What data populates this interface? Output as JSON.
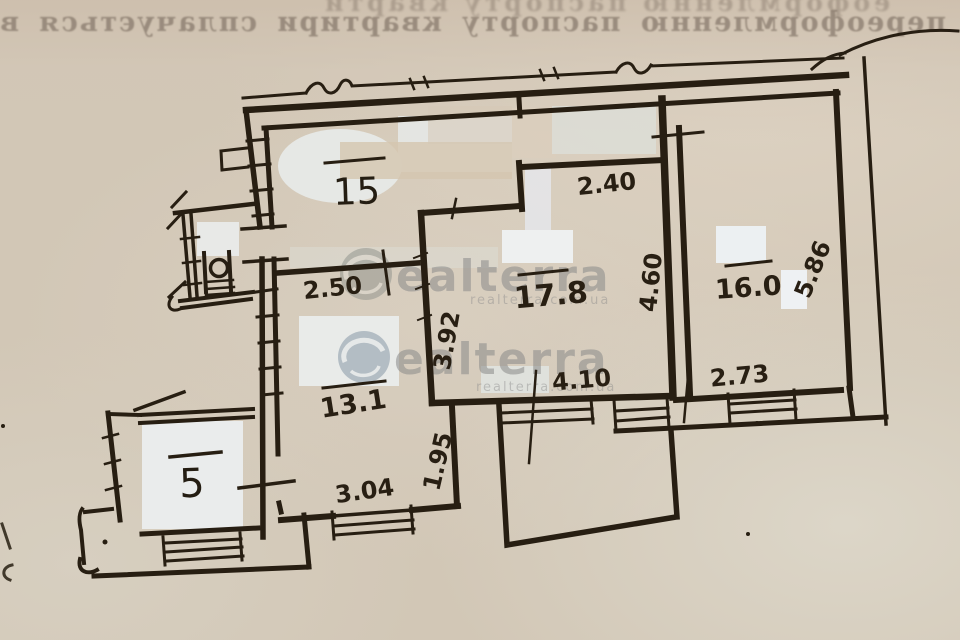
{
  "paper": {
    "base_color": "#d2c7b6",
    "ink_color": "#271e12"
  },
  "bleedthrough_text": {
    "line1": "еоформленню паспорту кварти",
    "line2": "переоформленню паспорту квартири сплачується ви"
  },
  "watermark": {
    "brand_text": "ealterra",
    "site_text": "realterra.com.ua",
    "color": "#8a8a8a"
  },
  "plan": {
    "rooms": [
      {
        "id": "room-15",
        "label": "15"
      },
      {
        "id": "room-17-8",
        "label": "17.8"
      },
      {
        "id": "room-16-0",
        "label": "16.0"
      },
      {
        "id": "hall-13-1",
        "label": "13.1"
      },
      {
        "id": "room-5",
        "label": "5"
      }
    ],
    "dimensions": [
      {
        "id": "dim-250",
        "label": "2.50"
      },
      {
        "id": "dim-240",
        "label": "2.40"
      },
      {
        "id": "dim-460",
        "label": "4.60"
      },
      {
        "id": "dim-392",
        "label": "3.92"
      },
      {
        "id": "dim-410",
        "label": "4.10"
      },
      {
        "id": "dim-273",
        "label": "2.73"
      },
      {
        "id": "dim-586",
        "label": "5.86"
      },
      {
        "id": "dim-195",
        "label": "1.95"
      },
      {
        "id": "dim-304",
        "label": "3.04"
      }
    ]
  }
}
